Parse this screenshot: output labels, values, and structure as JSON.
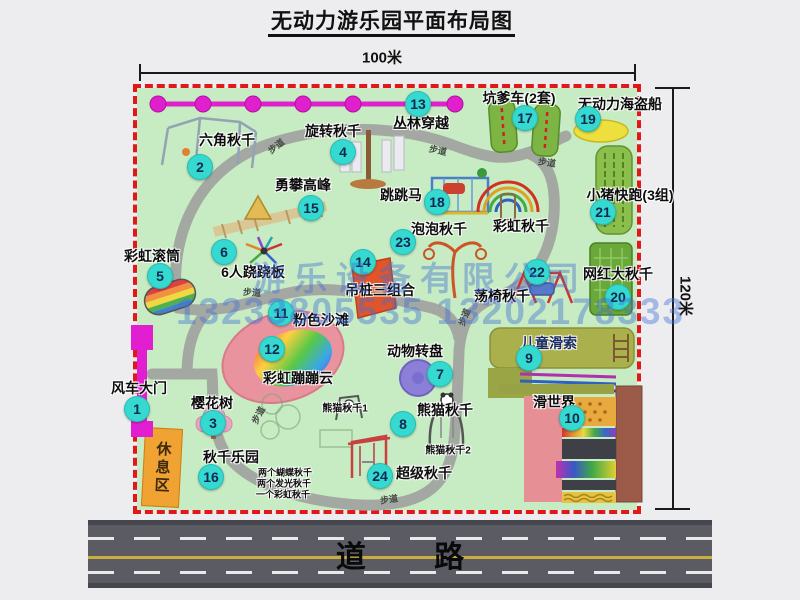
{
  "title": "无动力游乐园平面布局图",
  "dimensions": {
    "width_label": "100米",
    "height_label": "120米"
  },
  "road_label": "道 路",
  "rest_area_label": "休息区",
  "watermark": {
    "company": "游乐设备有限公司",
    "phone": "13233805535 13202178333"
  },
  "walkway_label": "步道",
  "walkway_label_positions": [
    {
      "x": 276,
      "y": 146,
      "r": -38
    },
    {
      "x": 438,
      "y": 150,
      "r": 12
    },
    {
      "x": 547,
      "y": 162,
      "r": 8
    },
    {
      "x": 252,
      "y": 292,
      "r": 4
    },
    {
      "x": 258,
      "y": 415,
      "r": -62
    },
    {
      "x": 464,
      "y": 317,
      "r": -68
    },
    {
      "x": 389,
      "y": 499,
      "r": -8
    }
  ],
  "items": [
    {
      "n": "1",
      "label": "风车大门",
      "label_center": [
        139,
        388
      ],
      "badge": [
        137,
        409
      ]
    },
    {
      "n": "2",
      "label": "六角秋千",
      "label_center": [
        227,
        140
      ],
      "badge": [
        200,
        167
      ]
    },
    {
      "n": "3",
      "label": "樱花树",
      "label_center": [
        212,
        403
      ],
      "badge": [
        213,
        423
      ]
    },
    {
      "n": "4",
      "label": "旋转秋千",
      "label_center": [
        333,
        131
      ],
      "badge": [
        343,
        152
      ]
    },
    {
      "n": "5",
      "label": "彩虹滚筒",
      "label_center": [
        152,
        256
      ],
      "badge": [
        160,
        276
      ]
    },
    {
      "n": "6",
      "label": "6人跷跷板",
      "label_center": [
        253,
        272
      ],
      "badge": [
        224,
        252
      ]
    },
    {
      "n": "7",
      "label": "动物转盘",
      "label_center": [
        415,
        351
      ],
      "badge": [
        440,
        374
      ]
    },
    {
      "n": "8",
      "label": "熊猫秋千",
      "label_center": [
        445,
        410
      ],
      "badge": [
        403,
        424
      ]
    },
    {
      "n": "9",
      "label": "儿童滑索",
      "label_center": [
        549,
        343
      ],
      "badge": [
        529,
        358
      ],
      "color": "#1b2c5e"
    },
    {
      "n": "10",
      "label": "滑世界",
      "label_center": [
        554,
        402
      ],
      "badge": [
        572,
        418
      ]
    },
    {
      "n": "11",
      "label": "粉色沙滩",
      "label_center": [
        321,
        320
      ],
      "badge": [
        281,
        313
      ]
    },
    {
      "n": "12",
      "label": "彩虹蹦蹦云",
      "label_center": [
        298,
        378
      ],
      "badge": [
        272,
        349
      ]
    },
    {
      "n": "13",
      "label": "丛林穿越",
      "label_center": [
        421,
        123
      ],
      "badge": [
        418,
        104
      ]
    },
    {
      "n": "14",
      "label": "吊桩三组合",
      "label_center": [
        380,
        290
      ],
      "badge": [
        363,
        262
      ]
    },
    {
      "n": "15",
      "label": "勇攀高峰",
      "label_center": [
        303,
        185
      ],
      "badge": [
        311,
        208
      ]
    },
    {
      "n": "16",
      "label": "秋千乐园",
      "label_center": [
        231,
        457
      ],
      "badge": [
        211,
        477
      ]
    },
    {
      "n": "17",
      "label": "坑爹车(2套)",
      "label_center": [
        519,
        98
      ],
      "badge": [
        525,
        118
      ]
    },
    {
      "n": "18",
      "label": "跳跳马",
      "label_center": [
        401,
        195
      ],
      "badge": [
        437,
        202
      ]
    },
    {
      "n": "19",
      "label": "无动力海盗船",
      "label_center": [
        620,
        104
      ],
      "badge": [
        588,
        119
      ]
    },
    {
      "n": "20",
      "label": "网红大秋千",
      "label_center": [
        618,
        274
      ],
      "badge": [
        618,
        297
      ]
    },
    {
      "n": "21",
      "label": "小猪快跑(3组)",
      "label_center": [
        630,
        195
      ],
      "badge": [
        603,
        212
      ]
    },
    {
      "n": "22",
      "label": "荡椅秋千",
      "label_center": [
        502,
        296
      ],
      "badge": [
        537,
        272
      ]
    },
    {
      "n": "23",
      "label": "泡泡秋千",
      "label_center": [
        439,
        229
      ],
      "badge": [
        403,
        242
      ]
    },
    {
      "n": "24",
      "label": "超级秋千",
      "label_center": [
        424,
        473
      ],
      "badge": [
        380,
        476
      ]
    }
  ],
  "extra_labels": [
    {
      "text": "彩虹秋千",
      "x": 521,
      "y": 226,
      "size": 14
    },
    {
      "text": "两个蝴蝶秋千",
      "x": 285,
      "y": 472,
      "size": 9
    },
    {
      "text": "两个发光秋千",
      "x": 284,
      "y": 483,
      "size": 9
    },
    {
      "text": "一个彩虹秋千",
      "x": 283,
      "y": 494,
      "size": 9
    },
    {
      "text": "熊猫秋千1",
      "x": 345,
      "y": 407,
      "size": 10
    },
    {
      "text": "熊猫秋千2",
      "x": 448,
      "y": 449,
      "size": 10
    }
  ],
  "colors": {
    "map_green": "#c7ebc2",
    "border_red": "#e01818",
    "badge_cyan": "#35d9cf",
    "gate_magenta": "#e11fd0",
    "jungle_line": "#e020cc",
    "path_gray": "#a4a8a2",
    "rest_orange": "#f0a232",
    "road_gray": "#5b5b64",
    "watermark_blue": "#4070d6"
  }
}
